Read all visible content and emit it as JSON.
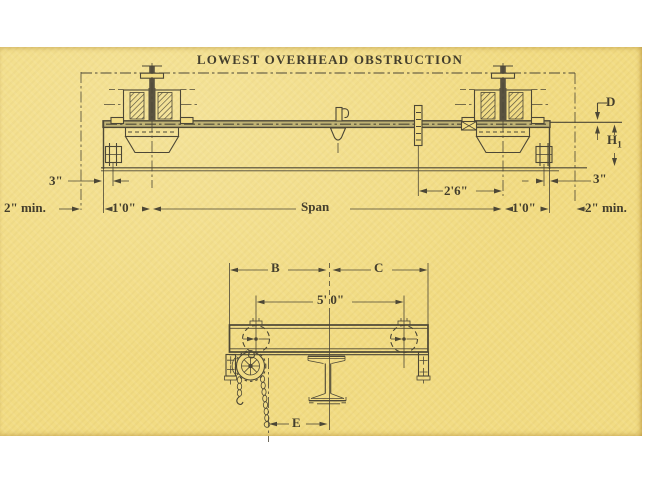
{
  "title": "LOWEST OVERHEAD OBSTRUCTION",
  "top_view": {
    "dim_3_left": "3\"",
    "dim_2min_left": "2\" min.",
    "dim_1ft0_left": "1'0\"",
    "dim_span": "Span",
    "dim_2ft6": "2'6\"",
    "dim_1ft0_right": "1'0\"",
    "dim_3_right": "3\"",
    "dim_2min_right": "2\" min.",
    "dim_d": "D",
    "dim_h1": {
      "base": "H",
      "sub": "1"
    }
  },
  "end_view": {
    "dim_b": "B",
    "dim_c": "C",
    "dim_5ft0": "5' 0\"",
    "dim_e": "E"
  },
  "colors": {
    "paper": "#f2dc83",
    "ink": "#4c4736",
    "margin": "#ffffff"
  }
}
